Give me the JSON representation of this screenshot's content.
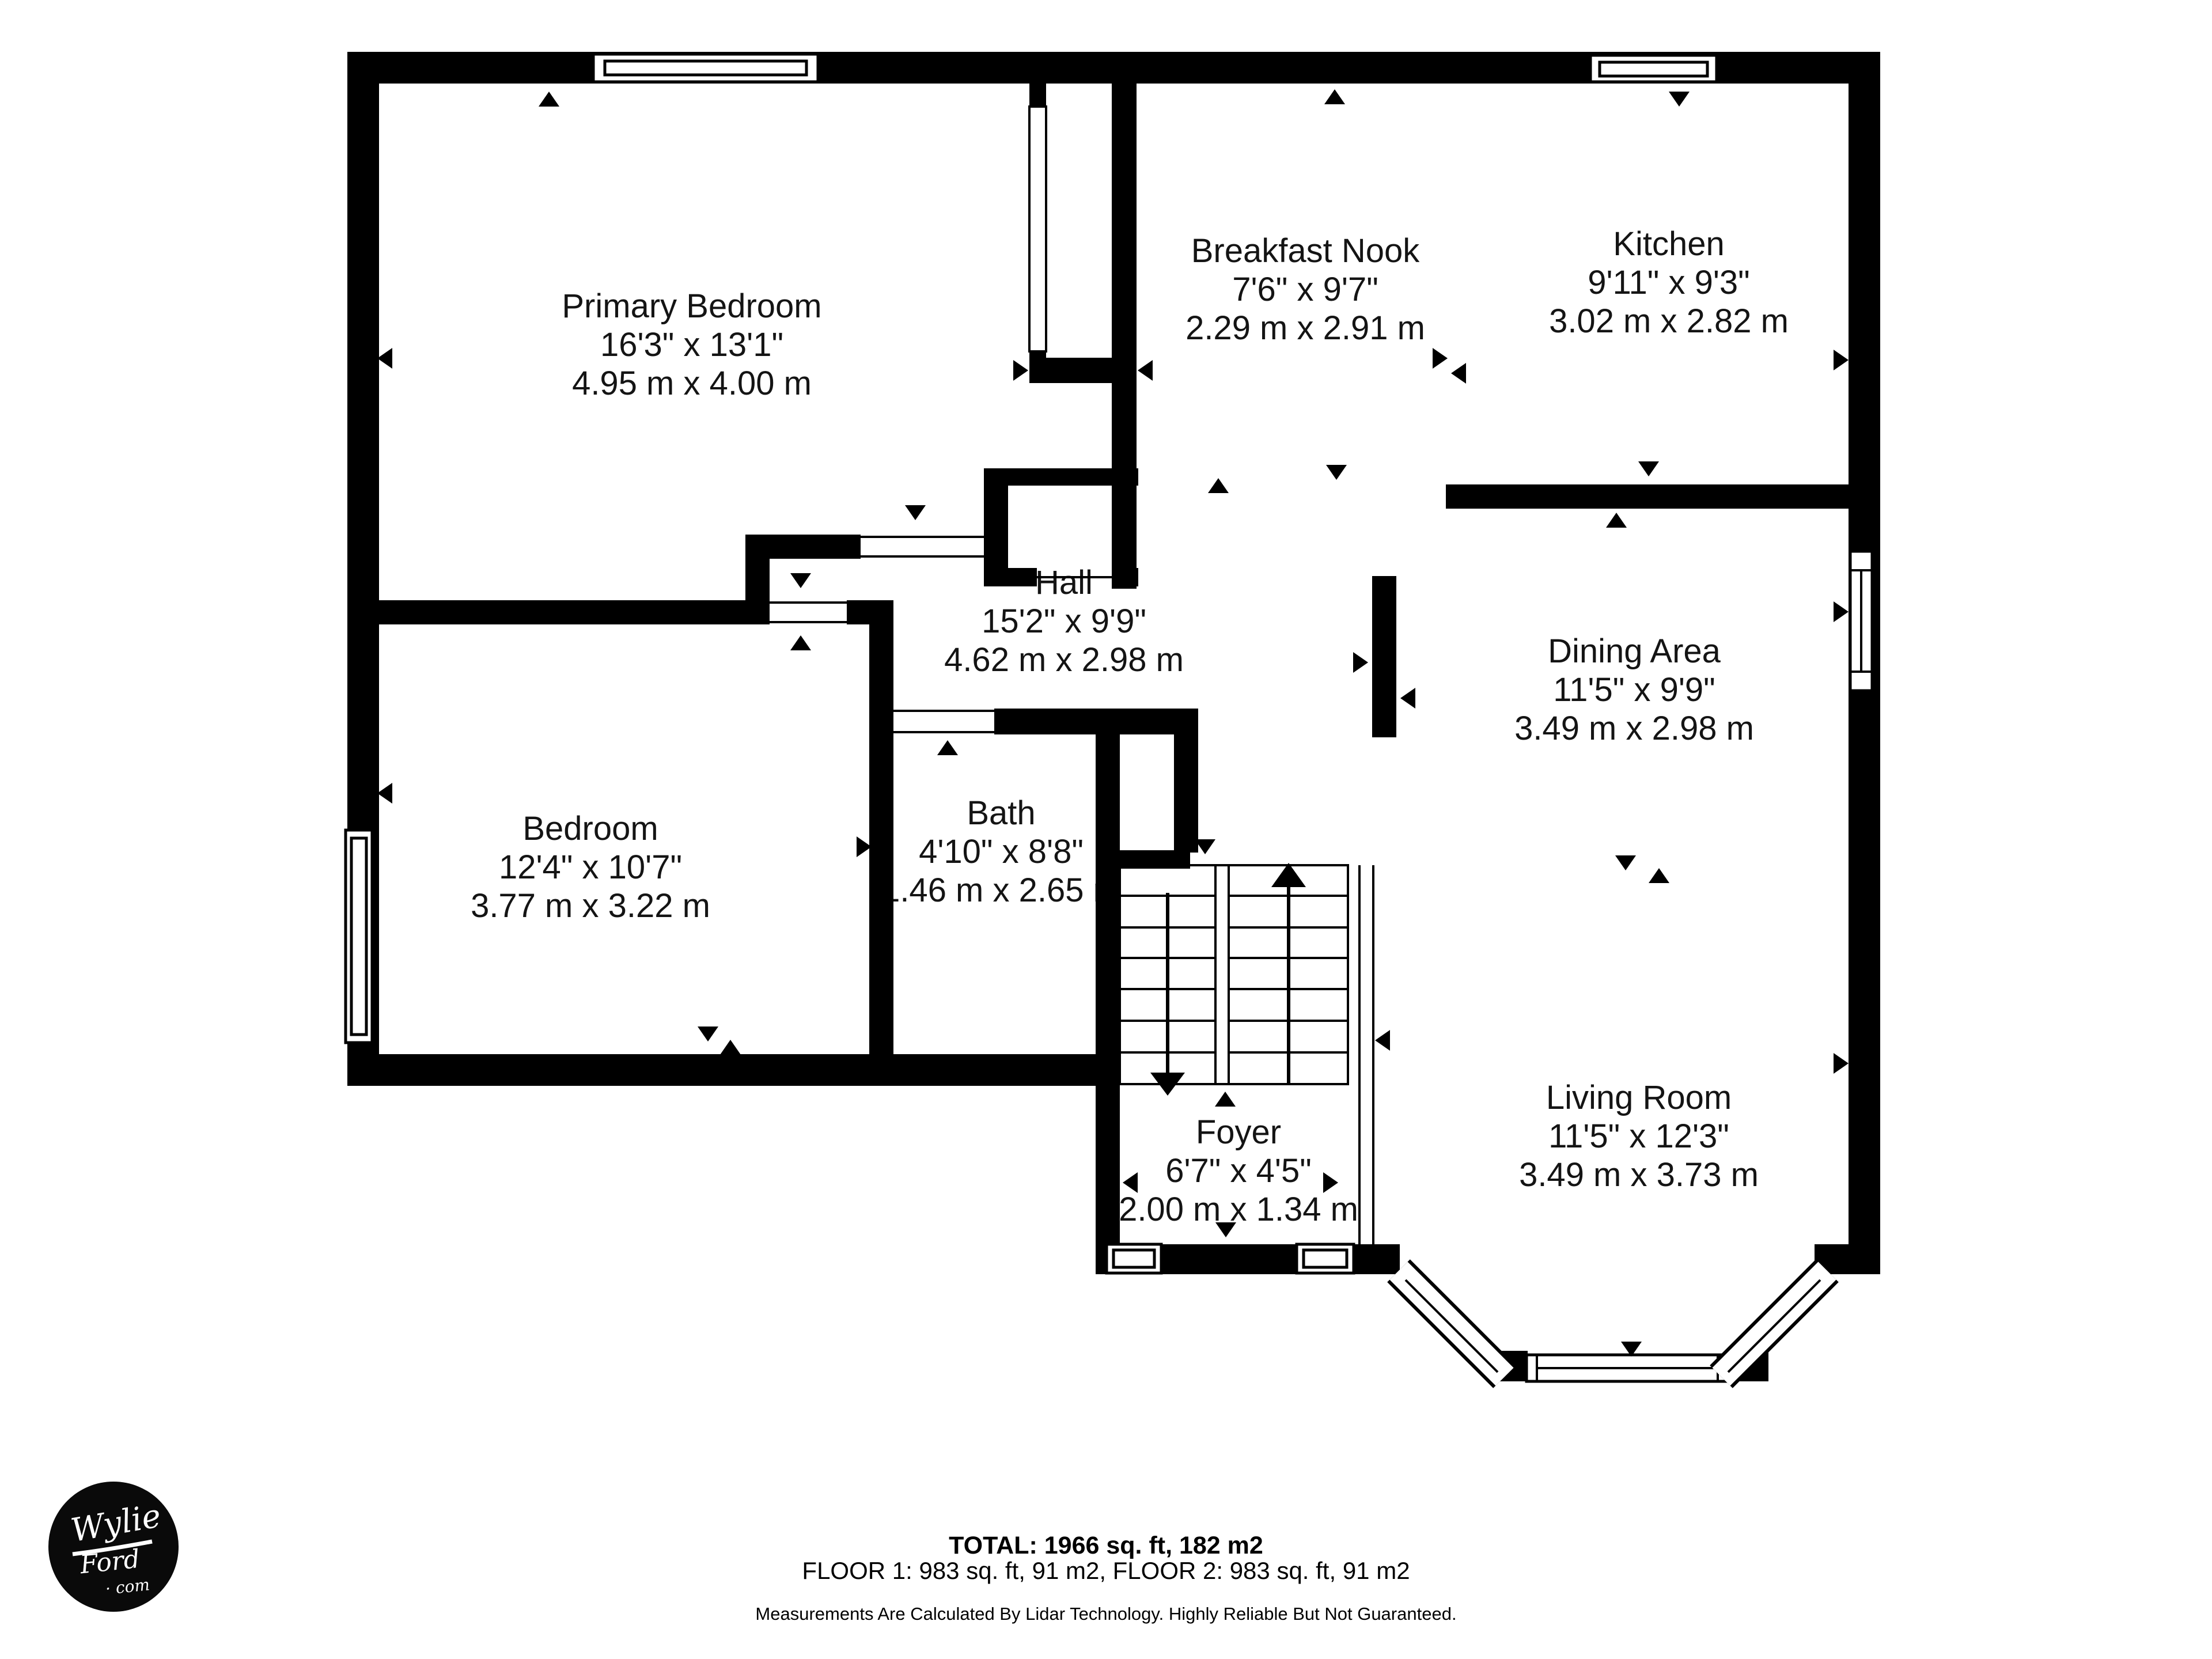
{
  "plan": {
    "rooms": [
      {
        "name": "Primary Bedroom",
        "imperial": "16'3\" x 13'1\"",
        "metric": "4.95 m x 4.00 m"
      },
      {
        "name": "Breakfast Nook",
        "imperial": "7'6\" x 9'7\"",
        "metric": "2.29 m x 2.91 m"
      },
      {
        "name": "Kitchen",
        "imperial": "9'11\" x 9'3\"",
        "metric": "3.02 m x 2.82 m"
      },
      {
        "name": "Hall",
        "imperial": "15'2\" x 9'9\"",
        "metric": "4.62 m x 2.98 m"
      },
      {
        "name": "Dining Area",
        "imperial": "11'5\" x 9'9\"",
        "metric": "3.49 m x 2.98 m"
      },
      {
        "name": "Bedroom",
        "imperial": "12'4\" x 10'7\"",
        "metric": "3.77 m x 3.22 m"
      },
      {
        "name": "Bath",
        "imperial": "4'10\" x 8'8\"",
        "metric": "1.46 m x 2.65 m"
      },
      {
        "name": "Foyer",
        "imperial": "6'7\" x 4'5\"",
        "metric": "2.00 m x 1.34 m"
      },
      {
        "name": "Living Room",
        "imperial": "11'5\" x 12'3\"",
        "metric": "3.49 m x 3.73 m"
      }
    ],
    "footer": {
      "total": "TOTAL: 1966 sq. ft, 182 m2",
      "floors": "FLOOR 1: 983 sq. ft, 91 m2, FLOOR 2: 983 sq. ft, 91 m2",
      "disclaimer": "Measurements Are Calculated By Lidar Technology. Highly Reliable But Not Guaranteed."
    },
    "logo": {
      "word1": "Wylie",
      "word2": "Ford",
      "word3": "· com"
    },
    "colors": {
      "wall": "#000000",
      "background": "#ffffff",
      "text": "#141414"
    }
  }
}
